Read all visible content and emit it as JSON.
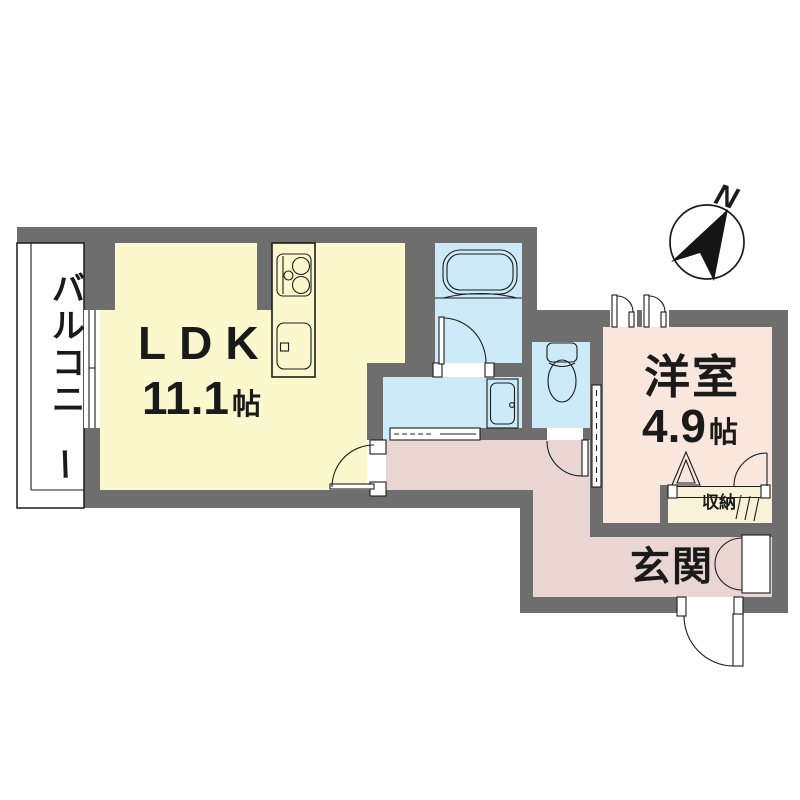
{
  "compass": {
    "label": "N"
  },
  "rooms": {
    "balcony": {
      "label": "バルコニー"
    },
    "ldk": {
      "label": "LDK",
      "size": "11.1",
      "unit": "帖"
    },
    "western": {
      "label": "洋室",
      "size": "4.9",
      "unit": "帖"
    },
    "entrance": {
      "label": "玄関"
    },
    "closet": {
      "label": "収納"
    }
  },
  "colors": {
    "wall": "#6e6e6e",
    "ldk": "#fbf8cd",
    "water": "#cdeaf8",
    "western": "#f9e7de",
    "hall": "#e9d6d2",
    "closet": "#f8f2d9",
    "compass": "#151515"
  }
}
